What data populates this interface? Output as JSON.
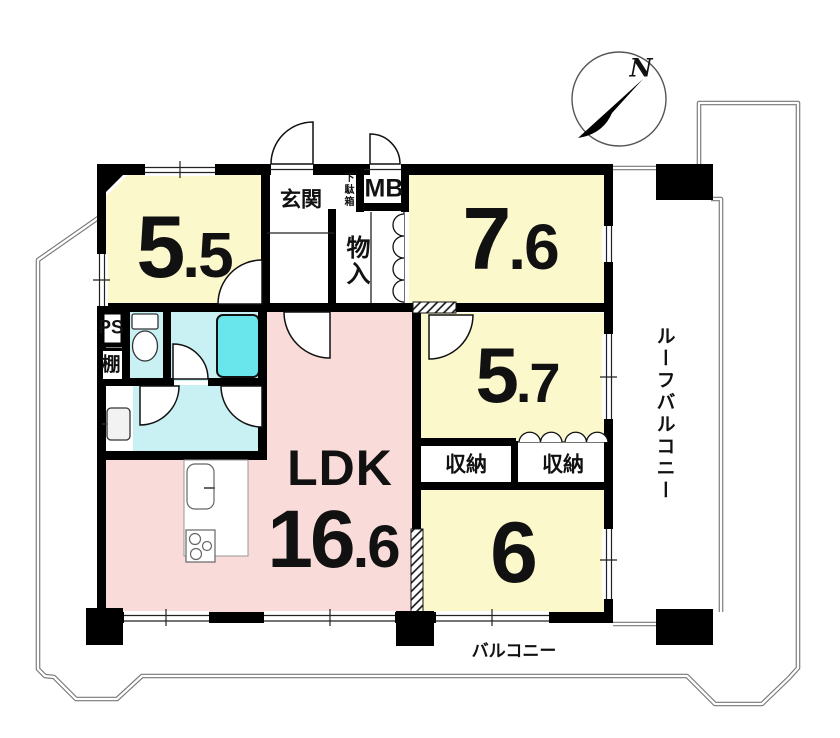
{
  "plan": {
    "compass": {
      "north": "N"
    },
    "rooms": {
      "bedroom_5_5": {
        "size_int": "5",
        "size_dec": ".5"
      },
      "bedroom_7_6": {
        "size_int": "7",
        "size_dec": ".6"
      },
      "bedroom_5_7": {
        "size_int": "5",
        "size_dec": ".7"
      },
      "bedroom_6": {
        "size": "6"
      },
      "ldk": {
        "name": "LDK",
        "size_int": "16",
        "size_dec": ".6"
      }
    },
    "labels": {
      "entrance": "玄関",
      "shoe_cabinet": "下駄箱",
      "meter_box": "MB",
      "closet": "物入",
      "storage_left": "収納",
      "storage_right": "収納",
      "pipe_space": "PS",
      "shelf": "棚",
      "roof_balcony": "ルーフバルコニー",
      "balcony": "バルコニー"
    },
    "colors": {
      "room_yellow": "#FBF8CB",
      "ldk_pink": "#F9DBDA",
      "wet_cyan": "#C9F1F3",
      "tub_cyan": "#69E6EB",
      "wall": "#000000",
      "outline": "#777777"
    }
  }
}
